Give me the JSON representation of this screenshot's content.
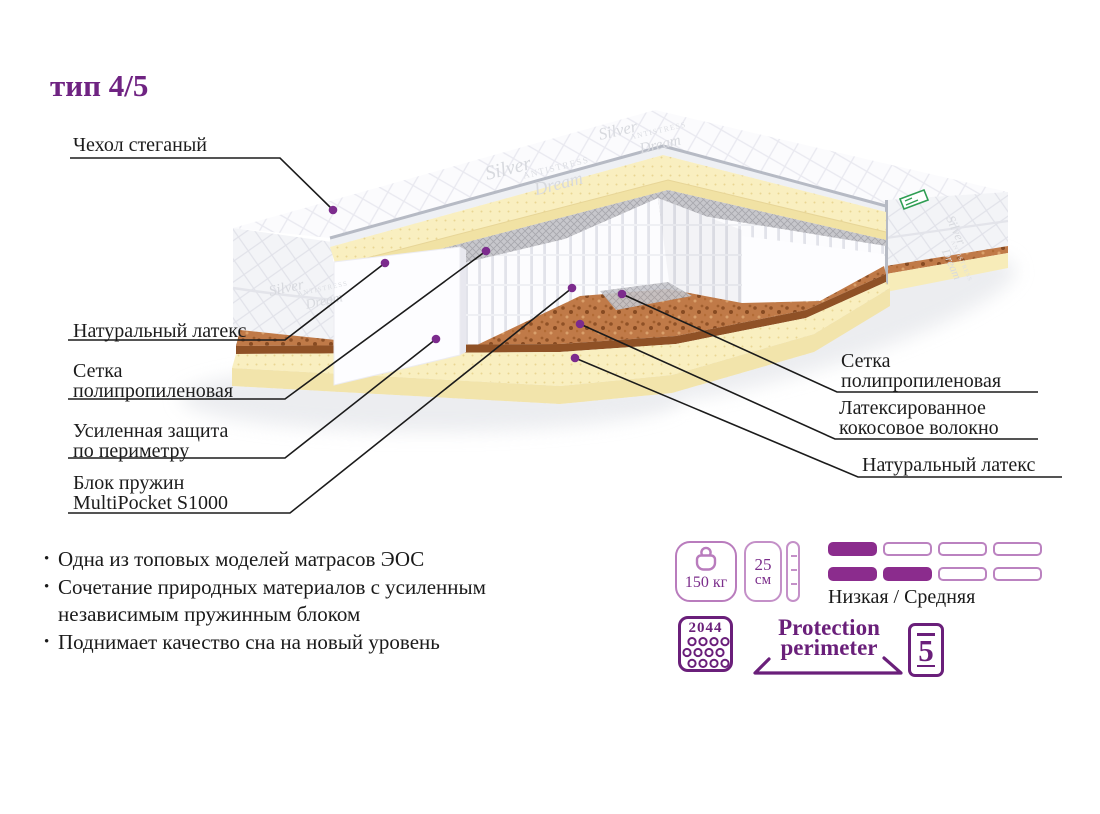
{
  "title": "тип 4/5",
  "callouts": {
    "cover": "Чехол стеганый",
    "latex_left": "Натуральный латекс",
    "mesh_left": "Сетка\nполипропиленовая",
    "perimeter": "Усиленная защита\nпо периметру",
    "springs": "Блок пружин\nMultiPocket S1000",
    "mesh_right": "Сетка\nполипропиленовая",
    "coir_right": "Латексированное\nкокосовое волокно",
    "latex_right": "Натуральный латекс"
  },
  "features": {
    "bullet_char": "•",
    "items": [
      "Одна из топовых моделей матрасов ЭОС",
      "Сочетание природных материалов с усиленным независимым пружинным блоком",
      "Поднимает качество сна на новый уровень"
    ]
  },
  "badges": {
    "max_weight": "150 кг",
    "height_value": "25",
    "height_unit": "см",
    "firmness_label": "Низкая / Средняя",
    "firmness_rows": [
      [
        1,
        0,
        0,
        0
      ],
      [
        1,
        1,
        0,
        0
      ]
    ],
    "springs_count": "2044",
    "protection_line1": "Protection",
    "protection_line2": "perimeter",
    "warranty": "5"
  },
  "watermark": {
    "line1": "Silver",
    "line2": "ANTISTRESS",
    "line3": "Dream"
  },
  "colors": {
    "accent": "#7b2d8b",
    "accent_dark": "#6a1f7a",
    "badge_outline": "#b97cbd",
    "pill_filled": "#8b2c8d",
    "latex": "#f7edba",
    "coir": "#c07a48",
    "mesh_gray": "#c7c7cc",
    "callout_line": "#1b1b1b"
  }
}
